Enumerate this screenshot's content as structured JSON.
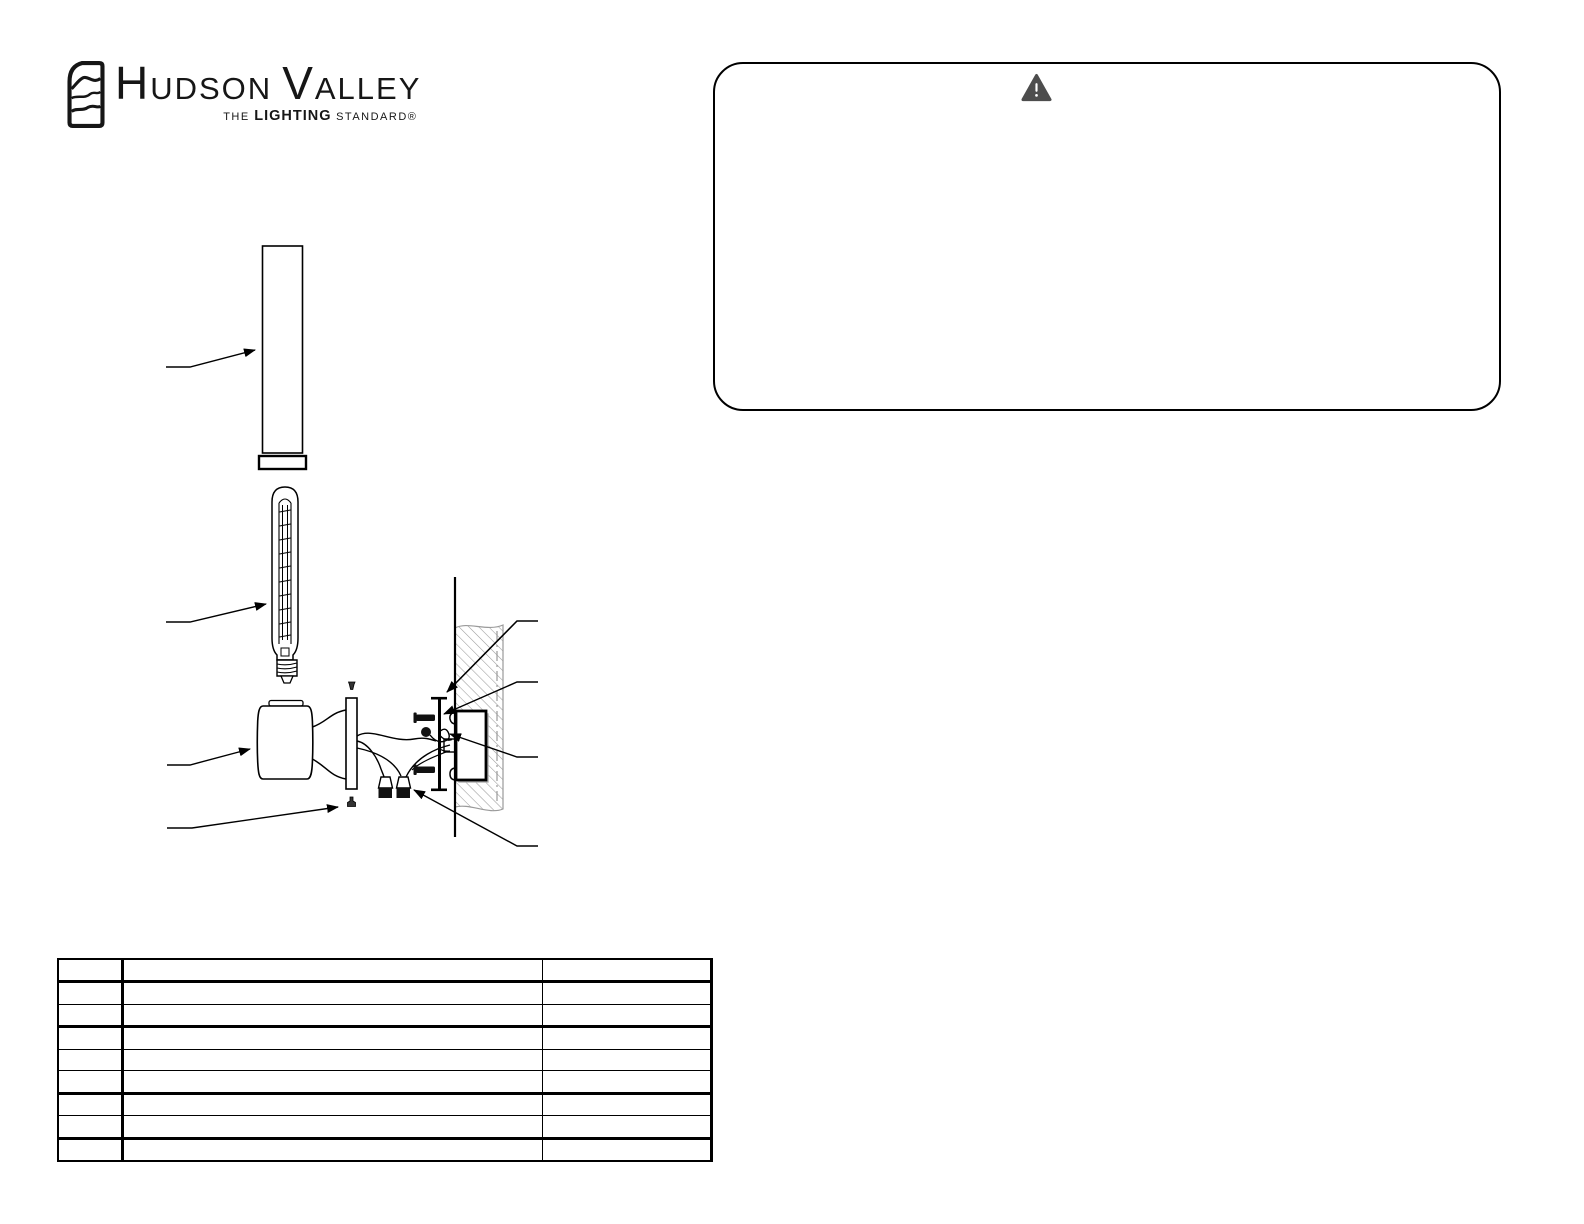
{
  "logo": {
    "word_part1": "H",
    "word_part2": "UDSON",
    "word_part3": "V",
    "word_part4": "ALLEY",
    "tagline": {
      "the": "THE ",
      "lighting": "LIGHTING",
      "standard": " STANDARD®"
    },
    "mark_icon": "hudson-valley-logo-mark",
    "ink_color": "#161616"
  },
  "warning_box": {
    "icon": "warning-triangle-icon",
    "icon_color": "#4d4d4d",
    "border_color": "#000000",
    "text": ""
  },
  "diagram": {
    "description": "exploded-wall-sconce-installation-diagram",
    "line_color": "#000000",
    "hatch_color": "#9a9a9a",
    "parts": [
      "glass-shade-cylinder",
      "shade-retaining-collar",
      "tubular-bulb",
      "fixture-body",
      "canopy-backplate",
      "canopy-screw-top",
      "canopy-screw-bottom",
      "lead-wires",
      "wire-connectors",
      "mounting-bracket",
      "mounting-screws",
      "ground-connection",
      "outlet-box",
      "wall-section"
    ]
  },
  "parts_table": {
    "columns": [
      "",
      "",
      ""
    ],
    "rows": [
      [
        "",
        "",
        ""
      ],
      [
        "",
        "",
        ""
      ],
      [
        "",
        "",
        ""
      ],
      [
        "",
        "",
        ""
      ],
      [
        "",
        "",
        ""
      ],
      [
        "",
        "",
        ""
      ],
      [
        "",
        "",
        ""
      ],
      [
        "",
        "",
        ""
      ],
      [
        "",
        "",
        ""
      ]
    ]
  }
}
